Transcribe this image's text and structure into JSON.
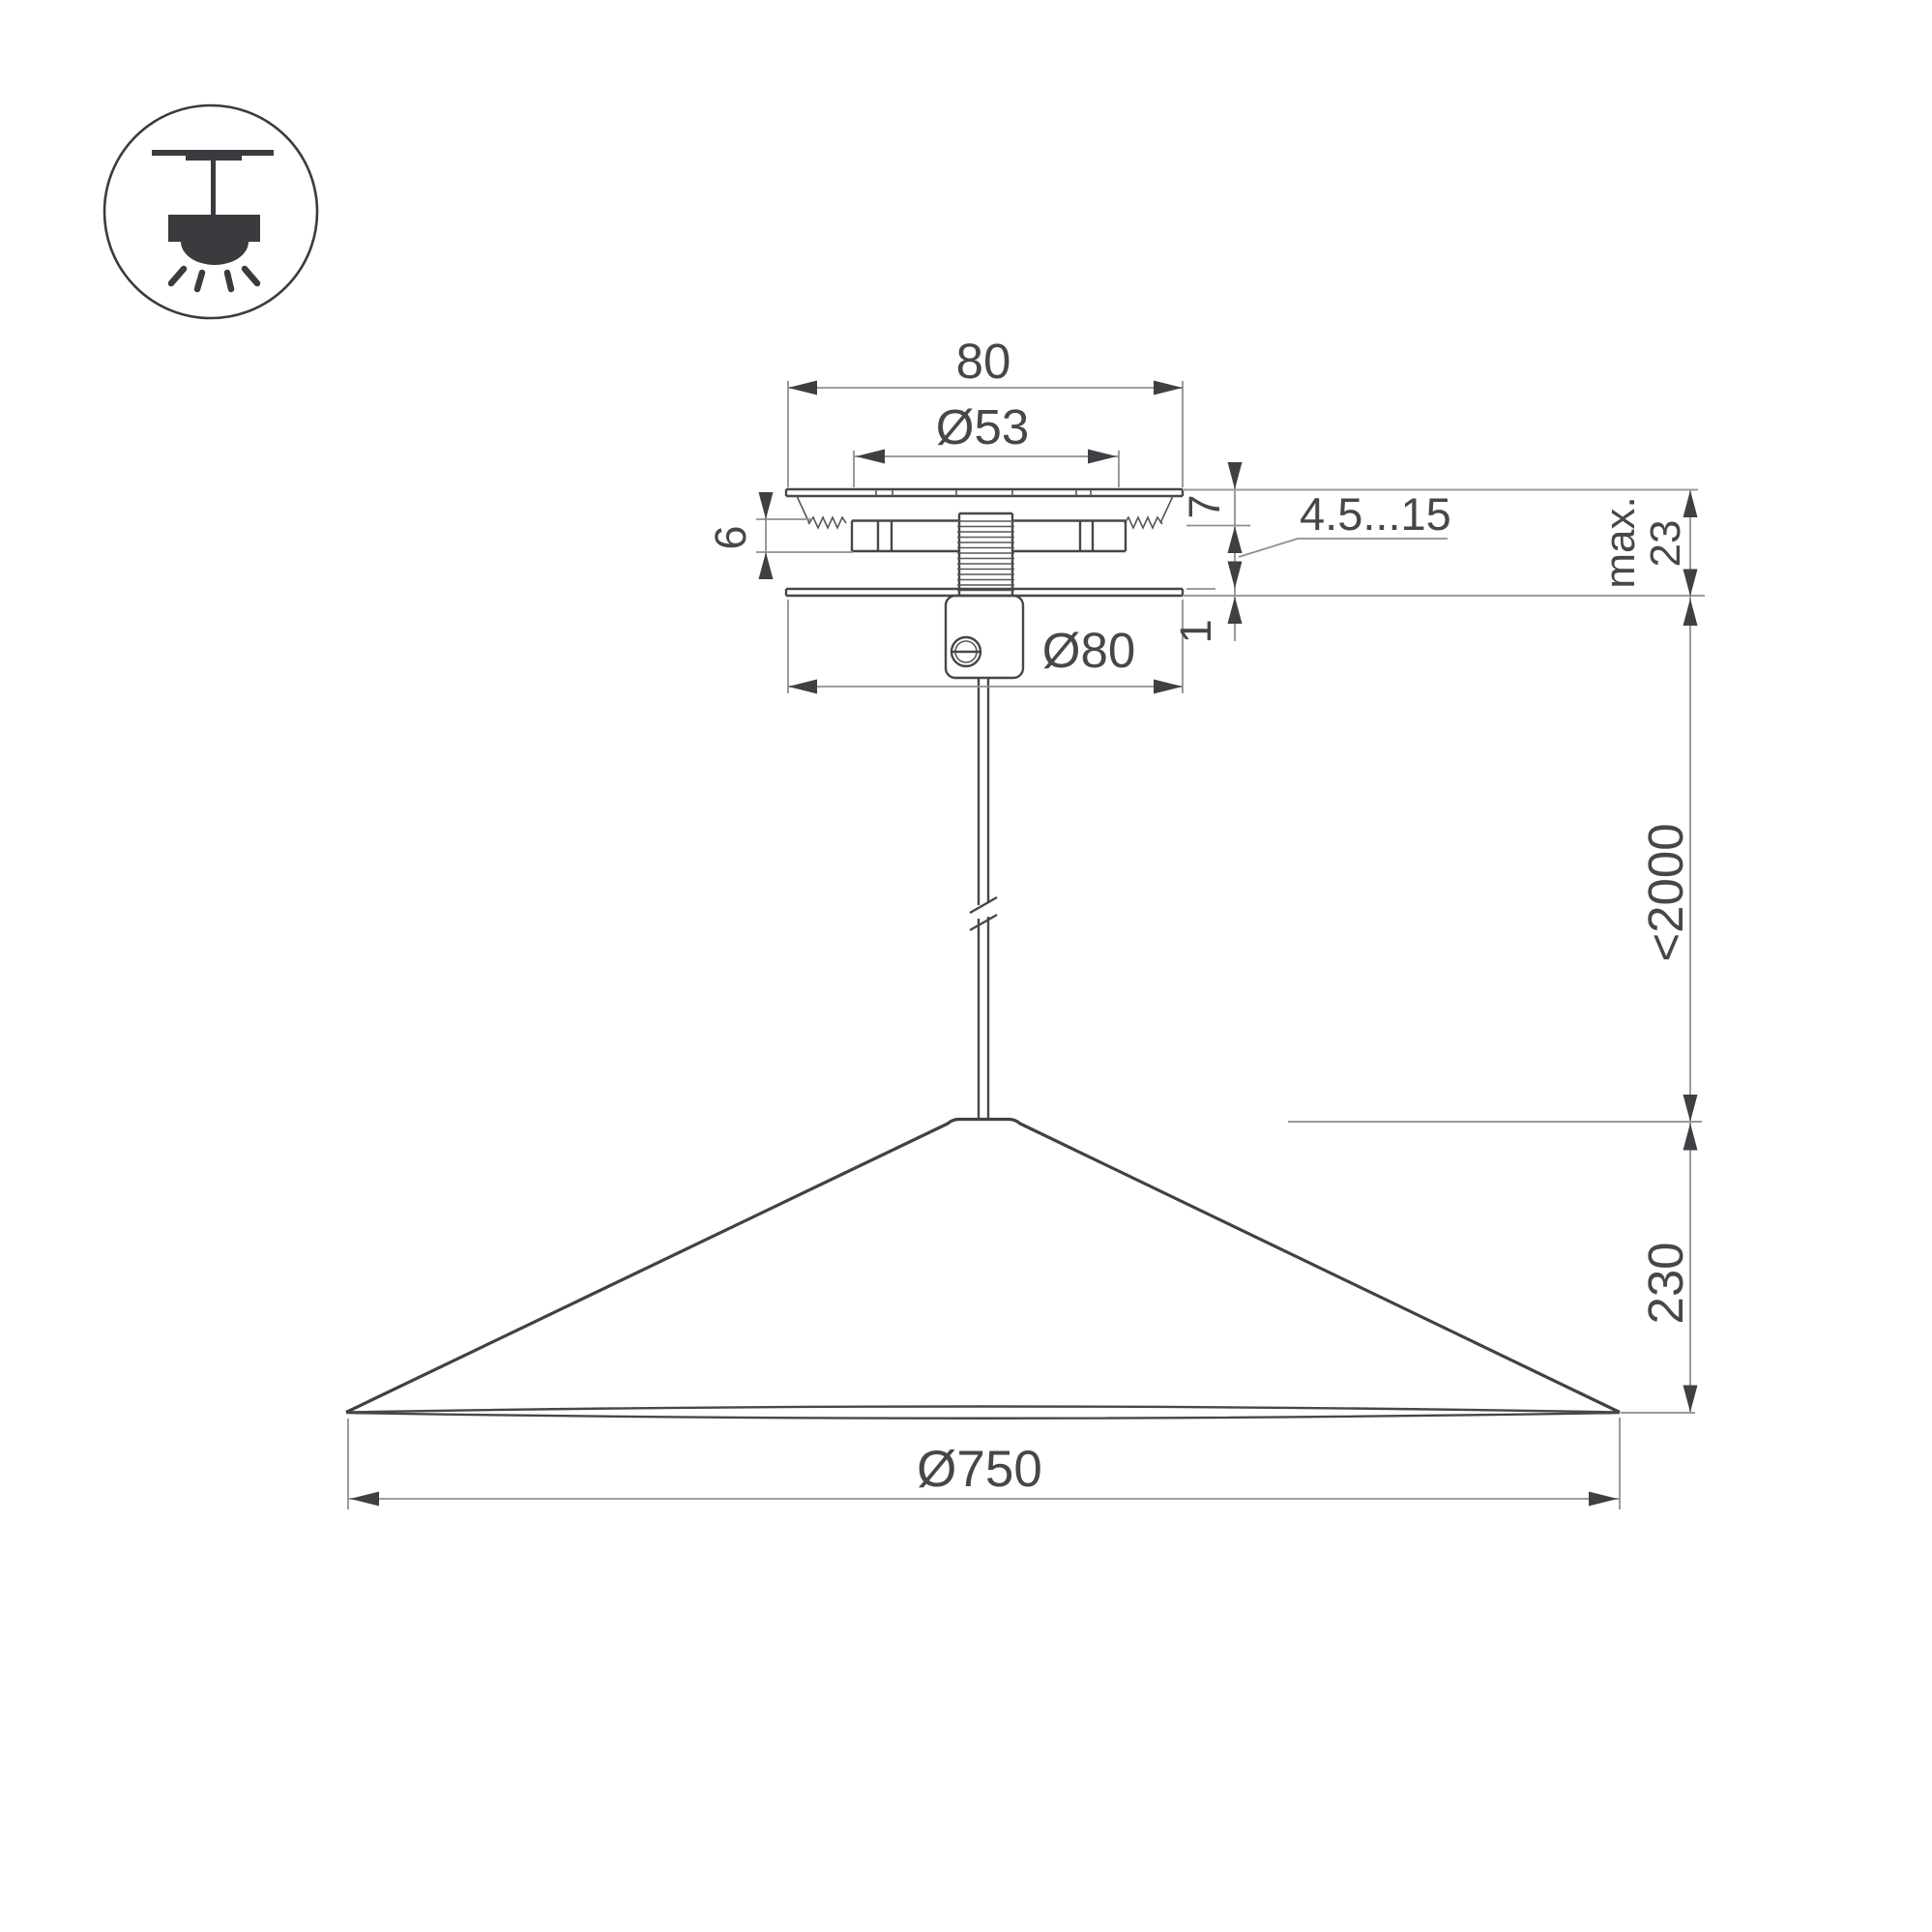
{
  "drawing": {
    "type": "pendant-lamp-mounting-technical-drawing",
    "background": "#ffffff",
    "colors": {
      "object_line": "#46474b",
      "dimension_line": "#8f9094",
      "text": "#46474b"
    },
    "icon": {
      "name": "pendant-ceiling-light-icon"
    }
  },
  "labels": {
    "top_width": "80",
    "hole_diameter": "Ø53",
    "plate_height": "7",
    "clamp_height": "6",
    "ceiling_range": "4.5...15",
    "max_label": "max.",
    "max_value": "23",
    "cover_thickness": "1",
    "canopy_diameter": "Ø80",
    "suspension_length": "<2000",
    "shade_height": "230",
    "shade_diameter": "Ø750"
  }
}
